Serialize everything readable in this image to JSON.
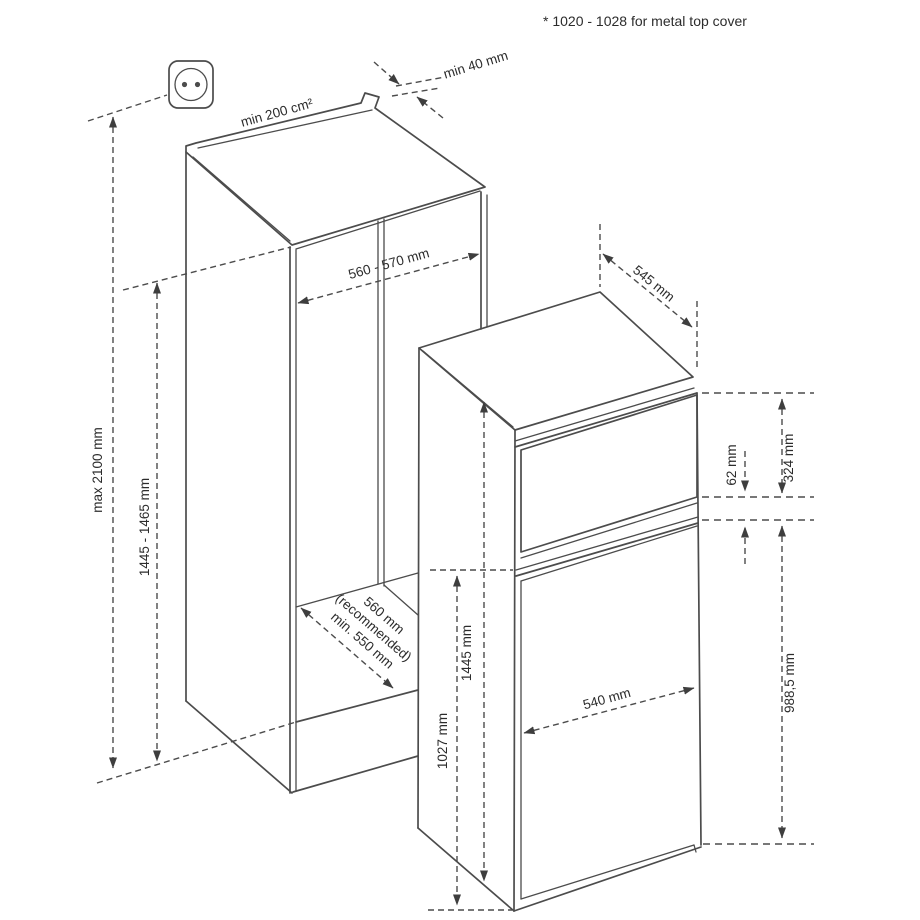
{
  "note": "* 1020 - 1028 for metal top cover",
  "labels": {
    "vent_area": "min 200 cm²",
    "top_clearance": "min 40 mm",
    "niche_width": "560 - 570 mm",
    "max_overall_height": "max 2100 mm",
    "niche_height": "1445 - 1465 mm",
    "depth_recommended_line1": "560 mm",
    "depth_recommended_line2": "(recommended)",
    "depth_recommended_line3": "min. 550 mm",
    "appliance_depth": "545 mm",
    "freezer_door_height": "324 mm",
    "door_gap": "62 mm",
    "lower_section_height": "988,5 mm",
    "appliance_height": "1445 mm",
    "lower_door_height": "1027 mm",
    "appliance_width": "540 mm"
  },
  "icons": {
    "socket": "power-socket-icon"
  },
  "colors": {
    "line": "#4c4c4c",
    "text": "#2c2c2c",
    "background": "#ffffff"
  }
}
